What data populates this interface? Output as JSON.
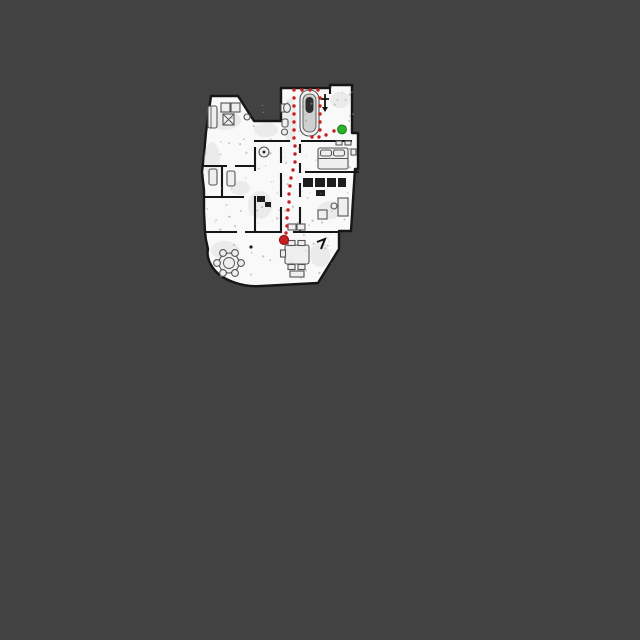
{
  "scene": {
    "description": "robot-vacuum-floorplan-map-with-path",
    "background_color": "#424242",
    "map_colors": {
      "floor": "#f9f9f9",
      "wall": "#161616",
      "furniture": "#555555",
      "noise": "#9a9a9a"
    },
    "robot": {
      "name": "robot-position",
      "x": 284,
      "y": 240,
      "radius": 4.6,
      "color": "#c42020",
      "edge_color": "#8f1313"
    },
    "destination": {
      "name": "destination-point",
      "x": 342,
      "y": 129.5,
      "radius": 4.4,
      "color": "#2bb32b",
      "edge_color": "#1d7a1d"
    },
    "path": {
      "name": "planned-path",
      "color": "#c42020",
      "dot_radius": 1.7,
      "dots": [
        [
          286,
          233
        ],
        [
          287,
          226
        ],
        [
          287,
          218
        ],
        [
          288,
          210
        ],
        [
          289,
          202
        ],
        [
          289,
          194
        ],
        [
          290,
          186
        ],
        [
          291,
          178
        ],
        [
          293,
          170
        ],
        [
          295,
          162
        ],
        [
          295,
          154
        ],
        [
          295,
          146
        ],
        [
          294,
          138
        ],
        [
          294,
          130
        ],
        [
          294,
          122
        ],
        [
          294,
          114
        ],
        [
          294,
          106
        ],
        [
          294,
          98
        ],
        [
          294,
          90
        ],
        [
          302,
          90
        ],
        [
          310,
          90
        ],
        [
          318,
          90
        ],
        [
          320,
          98
        ],
        [
          320,
          106
        ],
        [
          320,
          114
        ],
        [
          320,
          122
        ],
        [
          320,
          130
        ],
        [
          312,
          137
        ],
        [
          319,
          137
        ],
        [
          326,
          135
        ],
        [
          334,
          131
        ]
      ]
    },
    "features": [
      "bathtub",
      "toilet",
      "sink",
      "bed",
      "closet",
      "desk",
      "sofa",
      "armchair",
      "coffee-table",
      "round-table",
      "dining-table",
      "chairs",
      "sideboard",
      "bench"
    ]
  }
}
